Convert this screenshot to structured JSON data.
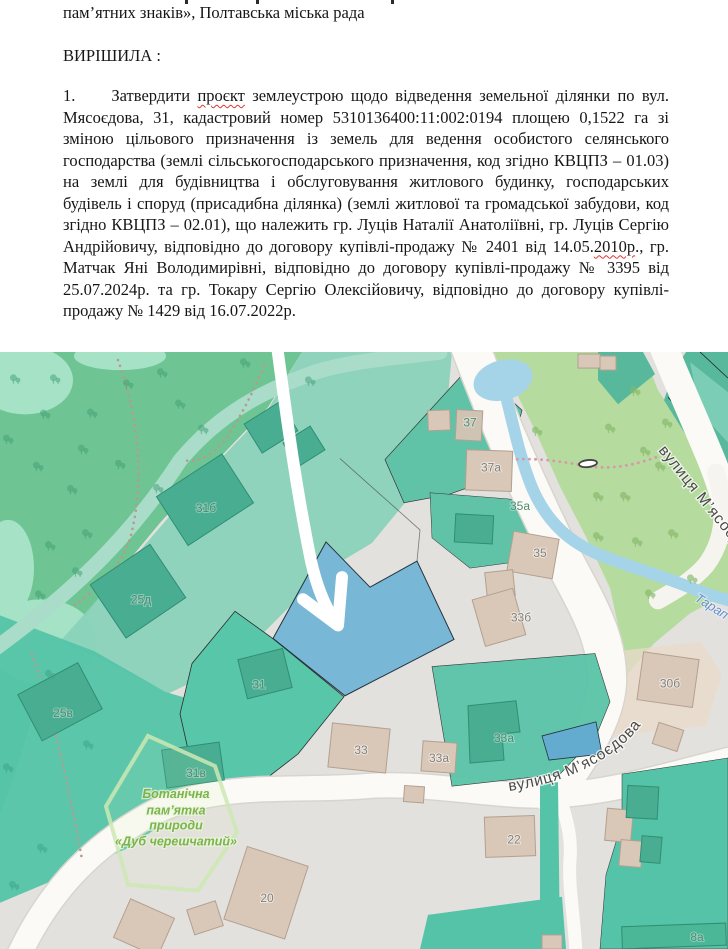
{
  "document": {
    "line_top": "пам’ятних знаків», Полтавська міська рада",
    "heading": "ВИРІШИЛА :",
    "paragraph": {
      "number": "1.",
      "part1": "Затвердити ",
      "misspelled1": "проєкт",
      "part2": " землеустрою щодо відведення земельної ділянки по вул. Мясоєдова, 31, кадастровий номер 5310136400:11:002:0194 площею 0,1522 га зі зміною цільового призначення із земель для ведення особистого селянського господарства (землі сільськогосподарського призначення, код згідно КВЦПЗ – 01.03) на землі для будівництва і обслуговування житлового будинку, господарських будівель і споруд (присадибна ділянка) (землі житлової та громадської забудови, код згідно КВЦПЗ – 02.01), що належить гр. Луців Наталії Анатоліївні, гр. Луців Сергію Андрійовичу, відповідно до договору купівлі-продажу № 2401 від 14.05.",
      "misspelled2": "2010р",
      "part3": "., гр. Матчак Яні Володимирівні, відповідно до договору купівлі-продажу № 3395 від 25.07.2024р. та гр. Токару Сергію Олексійовичу, відповідно до договору купівлі-продажу № 1429 від 16.07.2022р."
    }
  },
  "map": {
    "street_label_main": "вулиця М’ясоєдова",
    "street_label_upper": "вулиця М’ясоєдова",
    "stream_label": "Тарап",
    "protected_area": {
      "line1": "Ботанічна",
      "line2": "пам’ятка",
      "line3": "природи",
      "line4": "«Дуб черешчатий»"
    },
    "buildings": [
      {
        "label": "31б"
      },
      {
        "label": "25д"
      },
      {
        "label": "25в"
      },
      {
        "label": "31в"
      },
      {
        "label": "31"
      },
      {
        "label": "37"
      },
      {
        "label": "37а"
      },
      {
        "label": "35а"
      },
      {
        "label": "35"
      },
      {
        "label": "33б"
      },
      {
        "label": "30б"
      },
      {
        "label": "33"
      },
      {
        "label": "33а"
      },
      {
        "label": "33а"
      },
      {
        "label": "22"
      },
      {
        "label": "20"
      },
      {
        "label": "8а"
      }
    ],
    "colors": {
      "highlighted_parcel": "#79b7d7",
      "small_parcel": "#64abd0",
      "park_green": "#6ec593",
      "cadastral_teal": "#55c3a7",
      "grass": "#b5db9e",
      "water": "#a5d4e8",
      "road": "#fbfaf6",
      "residential_gray": "#e3e1de",
      "building_beige": "#d9c7b7",
      "arrow": "#ffffff",
      "squiggle_red": "#e03333"
    }
  }
}
